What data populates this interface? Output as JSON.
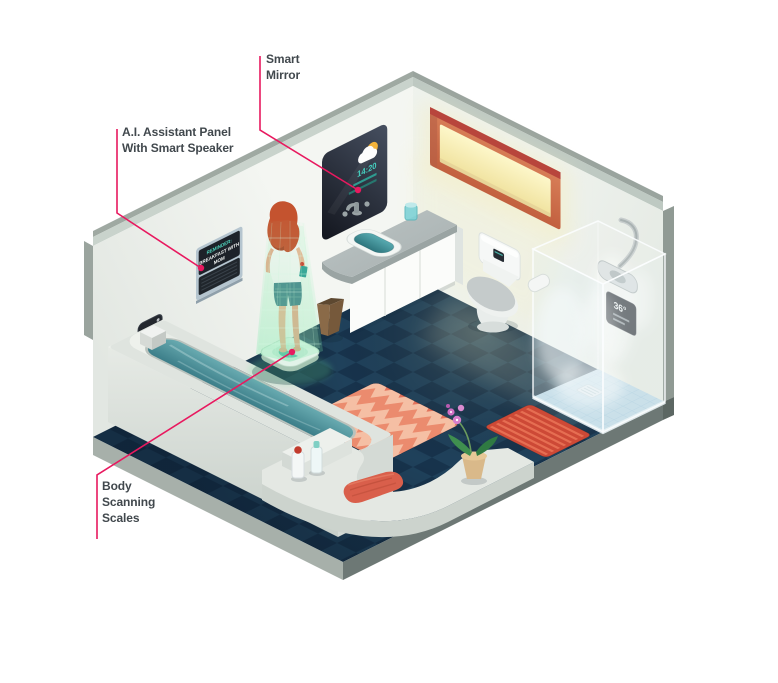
{
  "callouts": {
    "smart_mirror": "Smart Mirror",
    "ai_panel": "A.I. Assistant Panel With Smart Speaker",
    "body_scales": "Body Scanning Scales"
  },
  "devices": {
    "mirror": {
      "time": "14:20"
    },
    "wall_thermostat": {
      "temp": "36°"
    },
    "shower_panel": {
      "temp": "36°"
    },
    "ai_screen": {
      "line1": "REMINDER:",
      "line2": "BREAKFAST WITH",
      "line3": "MOM"
    }
  },
  "colors": {
    "accent_pink": "#e8195f",
    "hologram_green": "#7fe8a5",
    "floor_navy": "#17334c",
    "water_teal": "#4f9098",
    "window_glow": "#f7f0bf",
    "rug_coral": "#e2725b",
    "rug_red": "#cd4936",
    "label_text": "#41484d"
  }
}
